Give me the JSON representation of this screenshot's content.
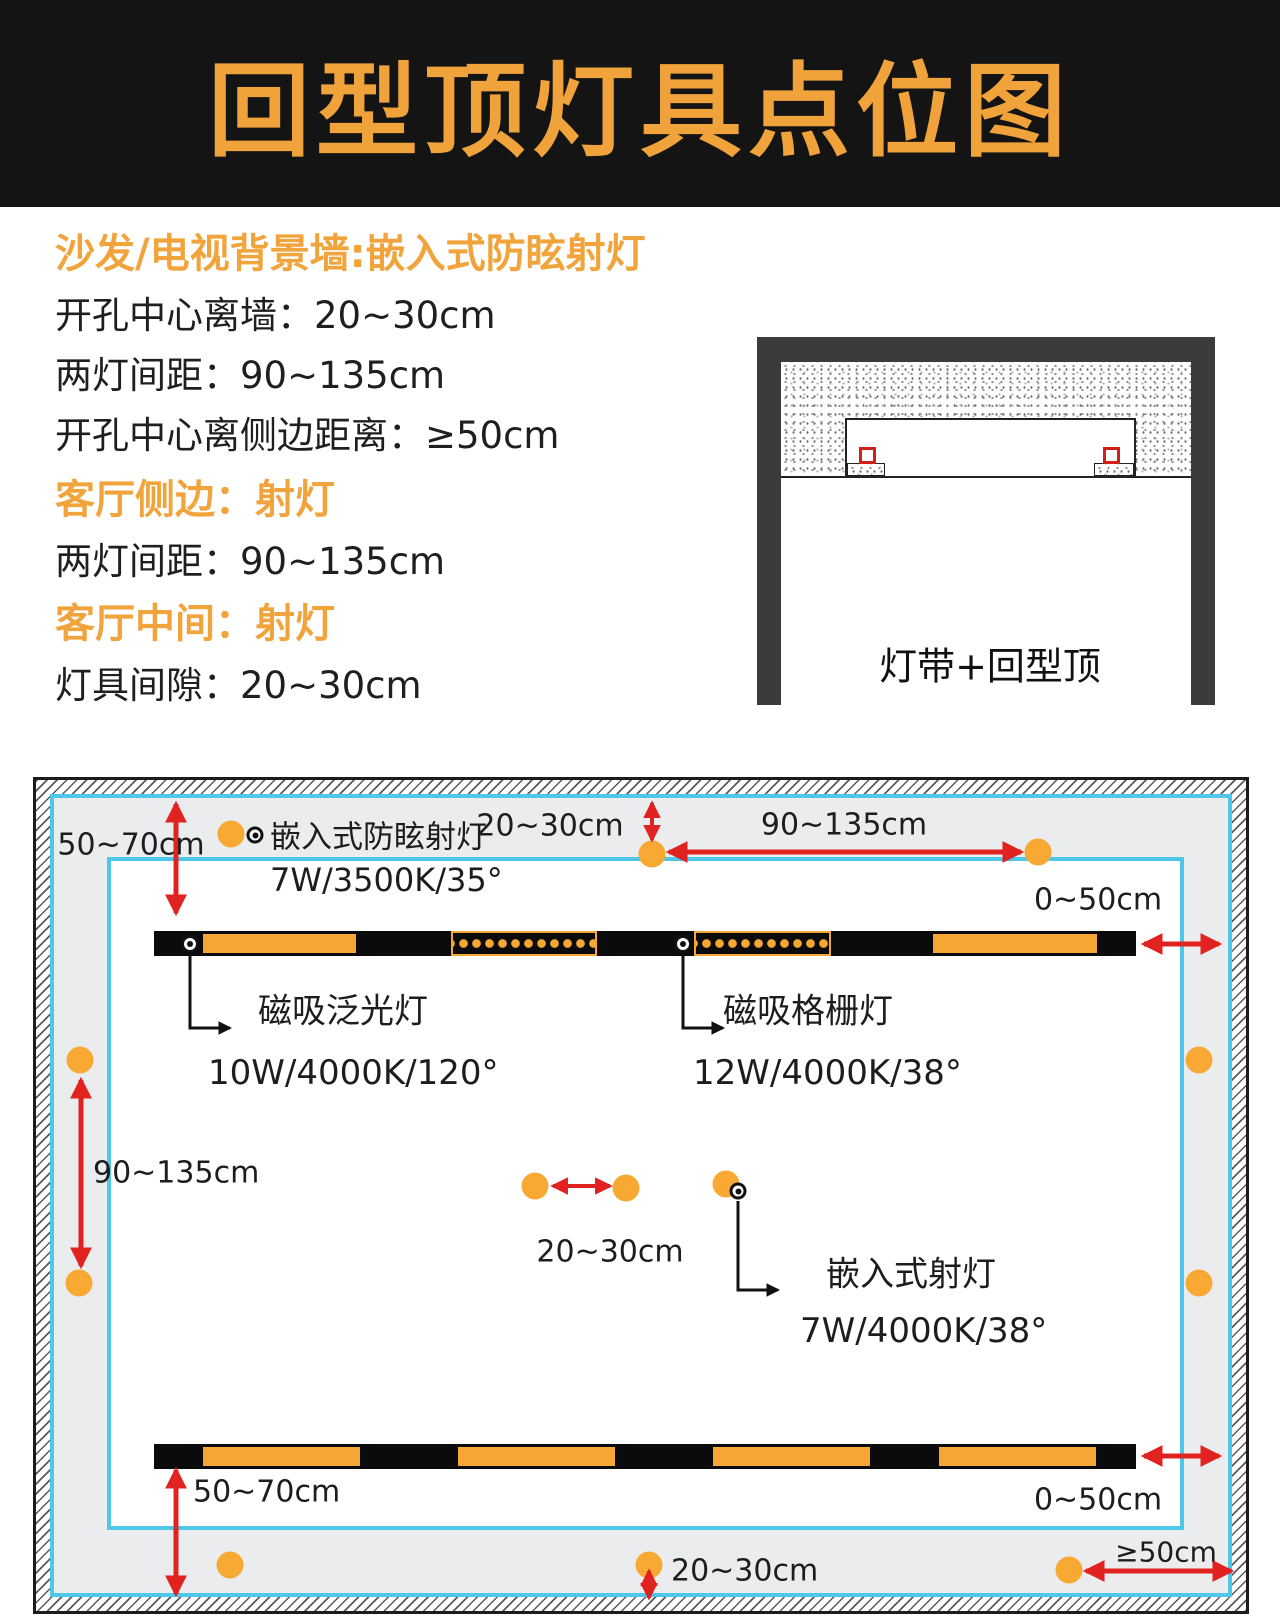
{
  "header": {
    "title": "回型顶灯具点位图"
  },
  "specs": {
    "heading1": "沙发/电视背景墙:嵌入式防眩射灯",
    "line1": "开孔中心离墙：20~30cm",
    "line2": "两灯间距：90~135cm",
    "line3": "开孔中心离侧边距离：≥50cm",
    "heading2": "客厅侧边：射灯",
    "line4": "两灯间距：90~135cm",
    "heading3": "客厅中间：射灯",
    "line5": "灯具间隙：20~30cm"
  },
  "section_diagram": {
    "caption": "灯带+回型顶"
  },
  "plan": {
    "legend": {
      "label": "嵌入式防眩射灯",
      "spec": "7W/3500K/35°"
    },
    "callouts": {
      "flood": {
        "label": "磁吸泛光灯",
        "spec": "10W/4000K/120°"
      },
      "grille": {
        "label": "磁吸格栅灯",
        "spec": "12W/4000K/38°"
      },
      "recessed": {
        "label": "嵌入式射灯",
        "spec": "7W/4000K/38°"
      }
    },
    "labels": {
      "top_left": "50~70cm",
      "wall_gap_top": "20~30cm",
      "spacing_top": "90~135cm",
      "side_top": "0~50cm",
      "side_left": "90~135cm",
      "center_gap": "20~30cm",
      "bottom_left": "50~70cm",
      "side_bottom": "0~50cm",
      "wall_gap_bottom": "20~30cm",
      "edge_min": "≥50cm"
    }
  },
  "colors": {
    "accent_orange": "#F0A23B",
    "dot_orange": "#F7A933",
    "arrow_red": "#E02220",
    "cyan_line": "#4EC7E8",
    "header_bg": "#141414",
    "band_gray": "#EBECEE",
    "frame_gray": "#3B3B3B"
  }
}
